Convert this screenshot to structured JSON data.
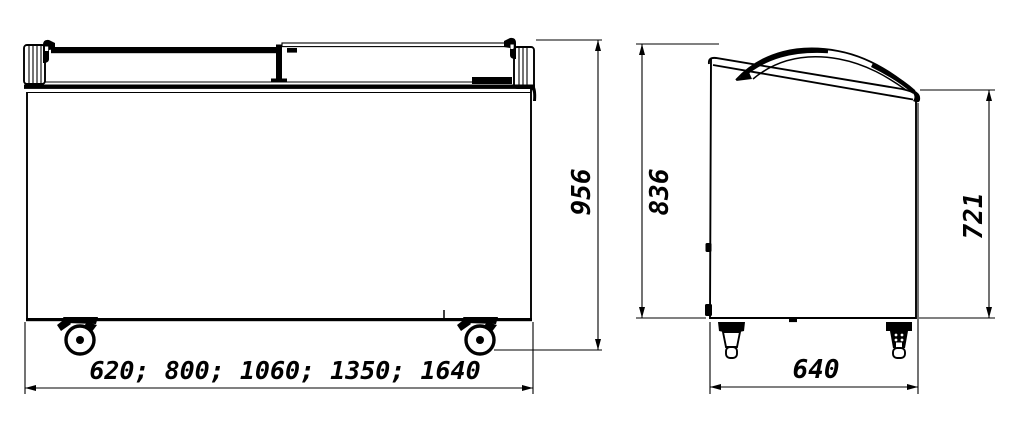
{
  "page": {
    "background_color": "#ffffff",
    "ink_color": "#000000",
    "content_type": "chest-freezer-dimension-drawing"
  },
  "dimensions": {
    "front_width_options_mm": "620; 800; 1060; 1350; 1640",
    "front_overall_height_mm": "956",
    "side_back_height_mm": "836",
    "side_front_height_mm": "721",
    "side_depth_mm": "640"
  }
}
